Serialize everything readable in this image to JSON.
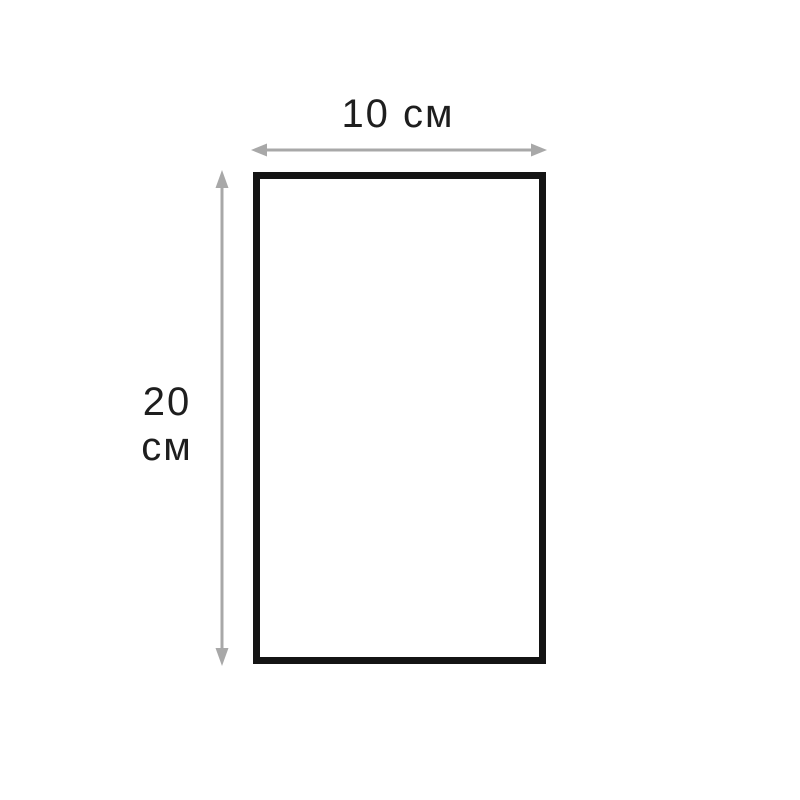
{
  "diagram": {
    "width_label": "10 см",
    "height_label_value": "20",
    "height_label_unit": "см",
    "colors": {
      "background": "#ffffff",
      "rectangle_border": "#141414",
      "dimension_arrow": "#a8a8a8",
      "label_text": "#1e1e1e"
    }
  }
}
